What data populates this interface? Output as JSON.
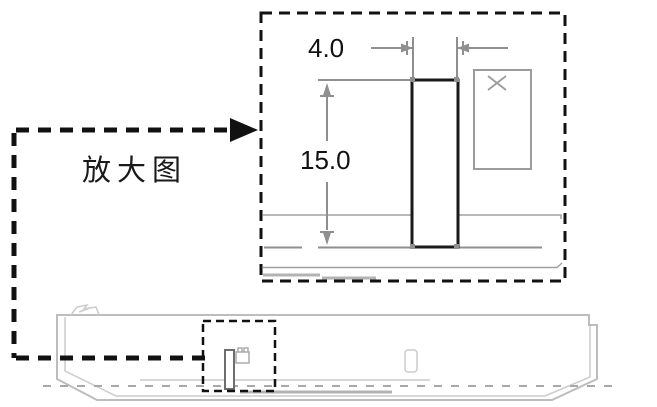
{
  "diagram": {
    "labels": {
      "magnified_view": "放大图"
    },
    "dimensions": {
      "width_label": "4.0",
      "height_label": "15.0"
    },
    "icons": {
      "cross_marker": "x-mark",
      "leader_arrow": "arrow-right"
    },
    "colors": {
      "background": "#ffffff",
      "line_dark": "#1a1a1a",
      "line_medium": "#8f8f8f",
      "line_light": "#bdbdbd",
      "text": "#111111"
    }
  }
}
